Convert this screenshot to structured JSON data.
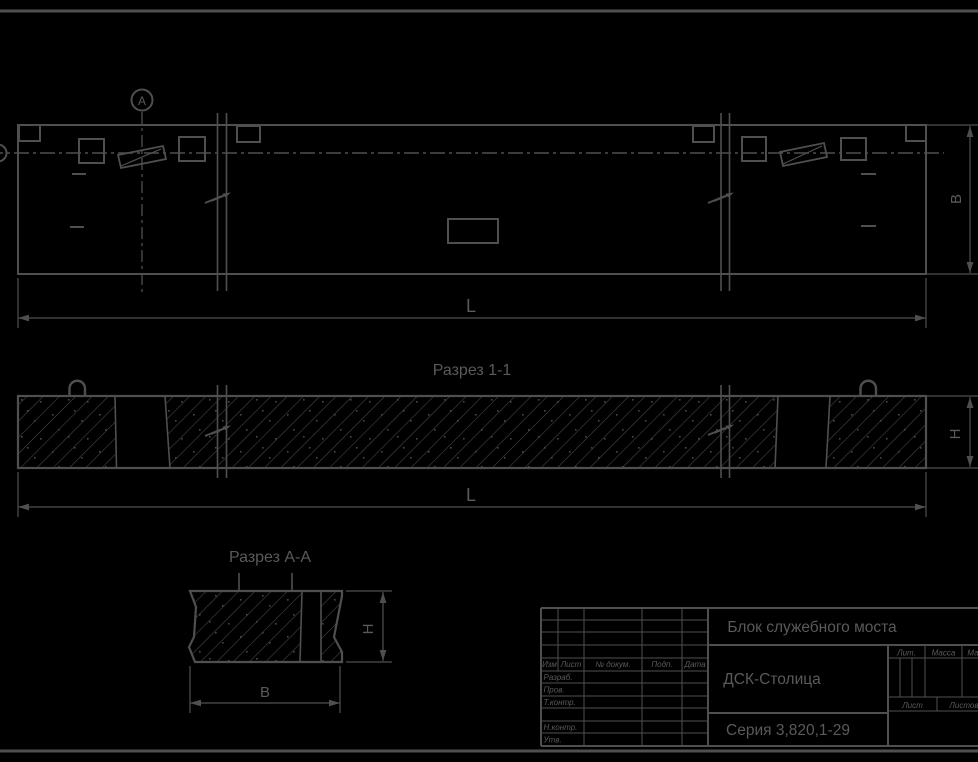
{
  "colors": {
    "background": "#000000",
    "line": "#4f4f4f",
    "text": "#5a5a5a",
    "hatch": "#454545"
  },
  "views": {
    "plan": {
      "detail_marker": "А",
      "dim_width": "В",
      "dim_length": "L"
    },
    "section_1_1": {
      "title": "Разрез 1-1",
      "dim_height": "Н",
      "dim_length": "L"
    },
    "section_a_a": {
      "title": "Разрез А-А",
      "dim_height": "Н",
      "dim_width": "В"
    }
  },
  "title_block": {
    "document_title": "Блок служебного моста",
    "organization": "ДСК-Столица",
    "series": "Серия 3,820,1-29",
    "change_header": {
      "izm": "Изм",
      "list": "Лист",
      "doc": "№ докум.",
      "podp": "Подп.",
      "data": "Дата"
    },
    "signature_rows": {
      "razrab": "Разраб.",
      "prov": "Пров.",
      "t_kontr": "Т.контр.",
      "n_kontr": "Н.контр.",
      "utv": "Утв."
    },
    "props": {
      "lit": "Лит.",
      "massa": "Масса",
      "masshtab": "Масштаб",
      "list": "Лист",
      "listov": "Листов"
    }
  }
}
